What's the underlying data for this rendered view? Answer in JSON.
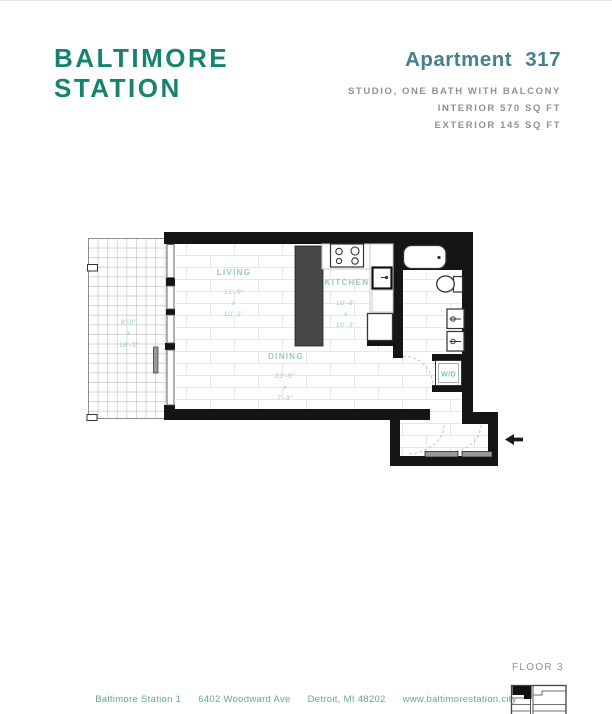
{
  "brand": {
    "line1": "BALTIMORE",
    "line2": "STATION"
  },
  "header": {
    "title": "Apartment 317",
    "subtitle1": "STUDIO, ONE BATH WITH BALCONY",
    "subtitle2": "INTERIOR 570 SQ FT",
    "subtitle3": "EXTERIOR 145 SQ FT"
  },
  "plan": {
    "rooms": {
      "living": {
        "name": "LIVING",
        "dim1": "12'-9\"",
        "sep": "x",
        "dim2": "10'-1\""
      },
      "kitchen": {
        "name": "KITCHEN",
        "dim1": "10'-8\"",
        "sep": "x",
        "dim2": "10'-1\""
      },
      "dining": {
        "name": "DINING",
        "dim1": "23'-5\"",
        "sep": "x",
        "dim2": "7'-3\""
      },
      "balcony": {
        "dim1": "8'-0\"",
        "sep": "x",
        "dim2": "18'-2\""
      },
      "laundry": {
        "name": "W/D"
      }
    }
  },
  "floor_key": {
    "label": "FLOOR 3"
  },
  "footer": {
    "items": [
      "Baltimore Station 1",
      "6402 Woodward Ave",
      "Detroit, MI 48202",
      "www.baltimorestation.city"
    ]
  },
  "colors": {
    "logo_teal": "#15836e",
    "heading_teal": "#44808d",
    "label_teal": "#93cbc2",
    "footer_teal": "#67a79f",
    "text_gray": "#8d9296",
    "wall_black": "#151515"
  }
}
